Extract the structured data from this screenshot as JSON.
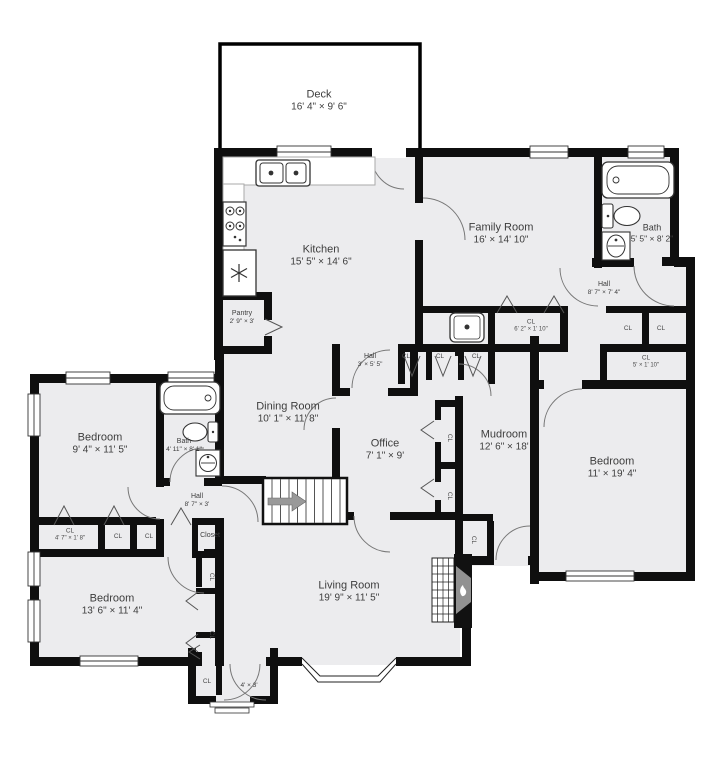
{
  "meta": {
    "type": "floor-plan",
    "colors": {
      "wall": "#0f0f0f",
      "room_fill": "#ececee",
      "label": "#3d3d3d",
      "background": "#ffffff",
      "fixture_stroke": "#333333",
      "arrow_gray": "#999999"
    }
  },
  "rooms": [
    {
      "id": "deck",
      "name": "Deck",
      "dims": "16' 4\" × 9' 6\"",
      "x": 319,
      "y": 101,
      "size": "lg"
    },
    {
      "id": "kitchen",
      "name": "Kitchen",
      "dims": "15' 5\" × 14' 6\"",
      "x": 321,
      "y": 256,
      "size": "lg"
    },
    {
      "id": "family-room",
      "name": "Family Room",
      "dims": "16' × 14' 10\"",
      "x": 501,
      "y": 234,
      "size": "lg"
    },
    {
      "id": "bath-upper",
      "name": "Bath",
      "dims": "5' 5\" × 8' 2\"",
      "x": 652,
      "y": 233,
      "size": "sm"
    },
    {
      "id": "hall-upper",
      "name": "Hall",
      "dims": "8' 7\" × 7' 4\"",
      "x": 604,
      "y": 289,
      "size": "xs"
    },
    {
      "id": "pantry",
      "name": "Pantry",
      "dims": "2' 9\" × 3'",
      "x": 242,
      "y": 318,
      "size": "xs"
    },
    {
      "id": "hall-center",
      "name": "Hall",
      "dims": "3' × 5' 5\"",
      "x": 370,
      "y": 361,
      "size": "xs"
    },
    {
      "id": "dining-room",
      "name": "Dining Room",
      "dims": "10' 1\" × 11' 8\"",
      "x": 288,
      "y": 413,
      "size": "lg"
    },
    {
      "id": "office",
      "name": "Office",
      "dims": "7' 1\" × 9'",
      "x": 385,
      "y": 450,
      "size": "lg"
    },
    {
      "id": "mudroom",
      "name": "Mudroom",
      "dims": "12' 6\" × 18'",
      "x": 504,
      "y": 441,
      "size": "lg"
    },
    {
      "id": "bedroom-right",
      "name": "Bedroom",
      "dims": "11' × 19' 4\"",
      "x": 612,
      "y": 468,
      "size": "lg"
    },
    {
      "id": "bedroom-upper-left",
      "name": "Bedroom",
      "dims": "9' 4\" × 11' 5\"",
      "x": 100,
      "y": 444,
      "size": "lg"
    },
    {
      "id": "bath-left",
      "name": "Bath",
      "dims": "4' 11\" × 8' 1\"",
      "x": 184,
      "y": 446,
      "size": "xs"
    },
    {
      "id": "hall-left",
      "name": "Hall",
      "dims": "8' 7\" × 3'",
      "x": 197,
      "y": 501,
      "size": "xs"
    },
    {
      "id": "closet-stairs",
      "name": "Closet",
      "dims": "",
      "x": 210,
      "y": 536,
      "size": "xs"
    },
    {
      "id": "bedroom-lower-left",
      "name": "Bedroom",
      "dims": "13' 6\" × 11' 4\"",
      "x": 112,
      "y": 605,
      "size": "lg"
    },
    {
      "id": "living-room",
      "name": "Living Room",
      "dims": "19' 9\" × 11' 5\"",
      "x": 349,
      "y": 592,
      "size": "lg"
    },
    {
      "id": "entry",
      "name": "",
      "dims": "4' × 3'",
      "x": 249,
      "y": 686,
      "size": "xs"
    }
  ],
  "closets": [
    {
      "label": "CL",
      "dims": "",
      "x": 406,
      "y": 357,
      "rot": 0
    },
    {
      "label": "CL",
      "dims": "",
      "x": 440,
      "y": 357,
      "rot": 0
    },
    {
      "label": "CL",
      "dims": "",
      "x": 476,
      "y": 357,
      "rot": 0
    },
    {
      "label": "CL",
      "dims": "6' 2\" × 1' 10\"",
      "x": 531,
      "y": 326,
      "rot": 0
    },
    {
      "label": "CL",
      "dims": "",
      "x": 628,
      "y": 329,
      "rot": 0
    },
    {
      "label": "CL",
      "dims": "",
      "x": 661,
      "y": 329,
      "rot": 0
    },
    {
      "label": "CL",
      "dims": "5' × 1' 10\"",
      "x": 646,
      "y": 362,
      "rot": 0
    },
    {
      "label": "CL",
      "dims": "4' 7\" × 1' 8\"",
      "x": 70,
      "y": 535,
      "rot": 0
    },
    {
      "label": "CL",
      "dims": "",
      "x": 118,
      "y": 537,
      "rot": 0
    },
    {
      "label": "CL",
      "dims": "",
      "x": 149,
      "y": 537,
      "rot": 0
    },
    {
      "label": "CL",
      "dims": "",
      "x": 211,
      "y": 577,
      "rot": 90
    },
    {
      "label": "CL",
      "dims": "",
      "x": 211,
      "y": 635,
      "rot": 90
    },
    {
      "label": "CL",
      "dims": "",
      "x": 207,
      "y": 682,
      "rot": 0
    },
    {
      "label": "CL",
      "dims": "",
      "x": 449,
      "y": 438,
      "rot": 90
    },
    {
      "label": "CL",
      "dims": "",
      "x": 449,
      "y": 496,
      "rot": 90
    },
    {
      "label": "CL",
      "dims": "",
      "x": 473,
      "y": 540,
      "rot": 90
    }
  ],
  "fixtures": [
    "kitchen-double-sink",
    "stove",
    "refrigerator",
    "pantry-bifold-door",
    "bathtub-upper",
    "toilet-upper",
    "pedestal-sink-upper",
    "bathtub-left",
    "toilet-left",
    "pedestal-sink-left",
    "utility-sink",
    "staircase",
    "stairs-direction-arrow",
    "fireplace",
    "bay-window",
    "entry-steps",
    "entry-double-door"
  ]
}
